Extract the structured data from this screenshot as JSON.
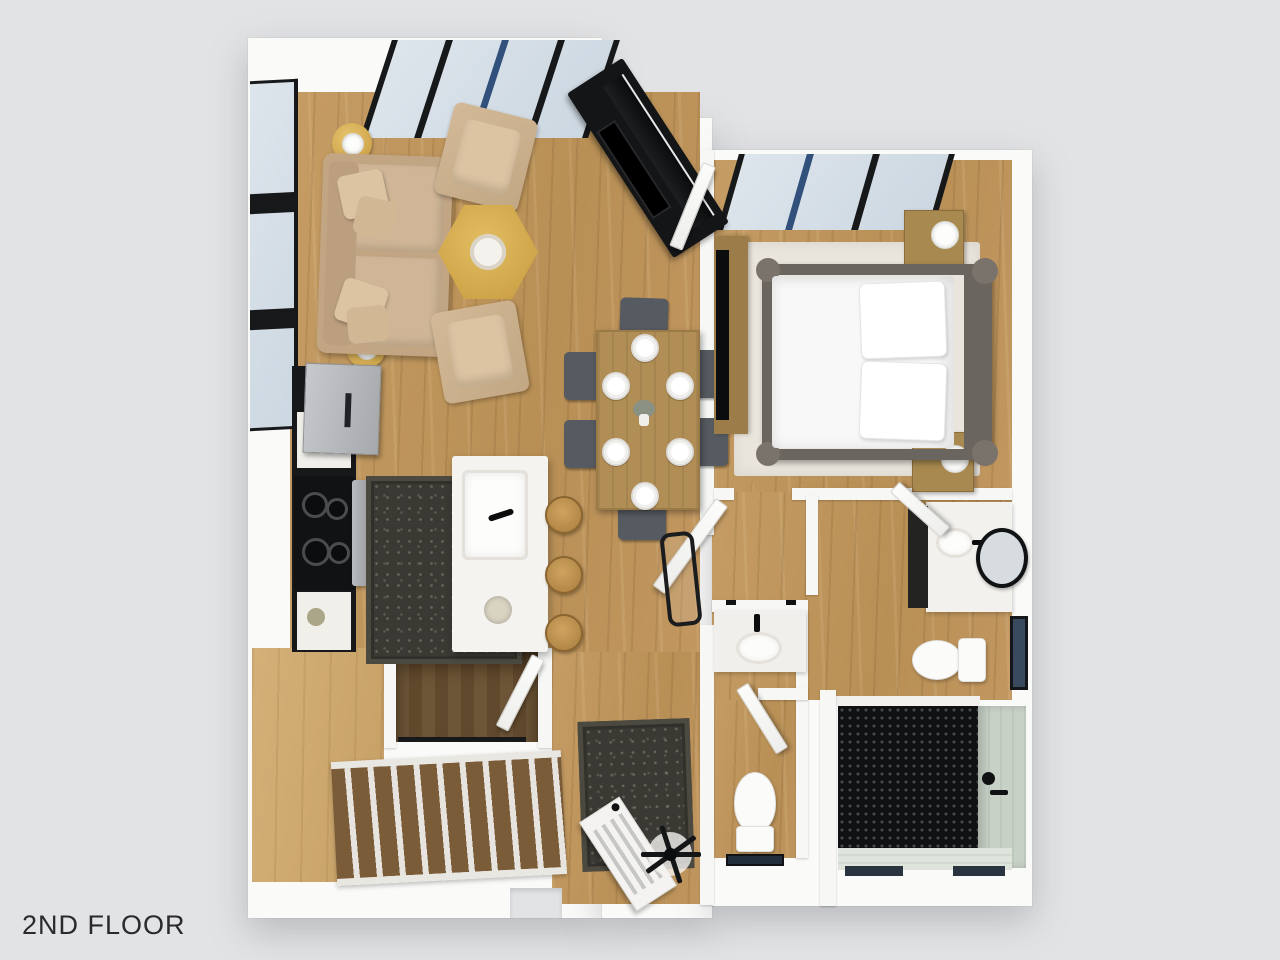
{
  "floor_label": {
    "text": "2ND FLOOR"
  },
  "scene": {
    "description": "3D rendered top-down floor plan of a second-floor apartment on a light gray backdrop",
    "colors": {
      "background": "#e2e3e5",
      "walls": "#fafaf9",
      "wood_floor": "#c49a62",
      "wood_floor_light": "#d0ac74",
      "stair_tread": "#7b5c39",
      "stairwell_wood": "#6d5537",
      "rug_dark": "#3b3933",
      "rug_light": "#e9e5dc",
      "sofa_tan": "#cbb091",
      "accent_gold": "#d9b258",
      "cabinet_black": "#17181a",
      "steel": "#b6b9bc",
      "glass_blue": "#d8e1ea",
      "frame_black": "#17181a",
      "frame_blue": "#31517c",
      "tile_sage": "#c7d1c6",
      "penny_tile_black": "#101113",
      "bedding_white": "#f8f8f8",
      "dining_chair_gray": "#565b61",
      "table_wood": "#b18e55"
    },
    "rooms": [
      {
        "name": "living-room",
        "items": [
          "sofa-with-pillows",
          "armchair",
          "armchair",
          "hexagon-coffee-table",
          "side-table-with-lamp",
          "side-table-with-lamp",
          "fireplace-tv-wall",
          "sliding-glass-doors",
          "tall-windows"
        ]
      },
      {
        "name": "dining-area",
        "items": [
          "wood-dining-table",
          "six-gray-chairs",
          "six-place-settings",
          "centerpiece-vase"
        ]
      },
      {
        "name": "kitchen",
        "items": [
          "refrigerator",
          "range-stove",
          "black-counter-run",
          "white-island-with-sink",
          "three-rattan-stools",
          "dark-patterned-rug"
        ]
      },
      {
        "name": "bedroom",
        "items": [
          "log-frame-bed",
          "white-bedding",
          "two-nightstands-with-lamps",
          "light-area-rug",
          "wall-tv-and-console",
          "sliding-glass-windows"
        ]
      },
      {
        "name": "bathroom",
        "items": [
          "vanity-with-sink",
          "black-round-mirror",
          "toilet",
          "window"
        ]
      },
      {
        "name": "shower-room",
        "items": [
          "black-penny-tile-floor",
          "sage-tile-walls",
          "black-shower-fixtures",
          "glass-partition"
        ]
      },
      {
        "name": "powder-room",
        "items": [
          "sink-vanity",
          "toilet",
          "small-window"
        ]
      },
      {
        "name": "stair-hall",
        "items": [
          "staircase-down",
          "stairwell-opening",
          "black-railing",
          "white-desk",
          "office-chair",
          "dark-patterned-rug"
        ]
      }
    ]
  }
}
